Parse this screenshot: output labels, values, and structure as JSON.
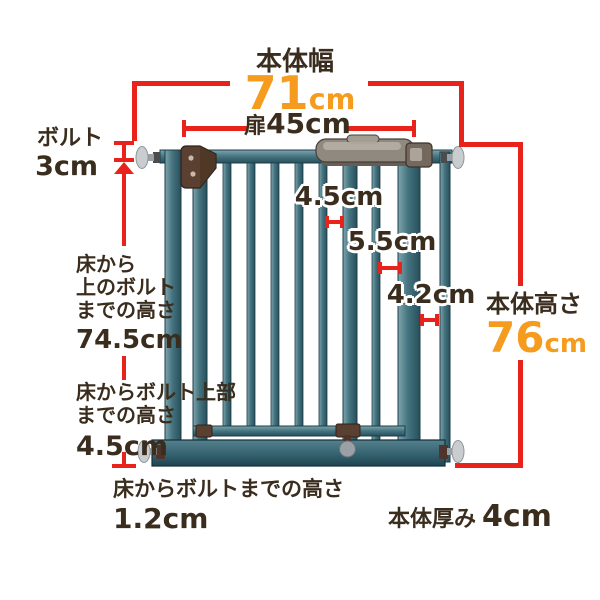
{
  "colors": {
    "background": "#ffffff",
    "dimension_red": "#e8231c",
    "number_orange": "#f59c1f",
    "text_dark": "#3a2d1e",
    "gate_teal": "#3f6d7b",
    "gate_teal_light": "#7fa5ae",
    "gate_teal_dark": "#274f5c",
    "hardware_brown": "#5a4030",
    "handle_gray": "#90897f",
    "bolt_gray": "#c9cdd0"
  },
  "annotations": {
    "body_width": {
      "label": "本体幅",
      "value": "71",
      "unit": "cm"
    },
    "door_width": {
      "label": "扉",
      "value": "45cm"
    },
    "bolt": {
      "label": "ボルト",
      "value": "3cm"
    },
    "floor_to_upper_bolt": {
      "lines": [
        "床から",
        "上のボルト",
        "までの高さ"
      ],
      "value": "74.5cm"
    },
    "floor_to_bolt_top": {
      "lines": [
        "床からボルト上部",
        "までの高さ"
      ],
      "value": "4.5cm"
    },
    "floor_to_bolt": {
      "label": "床からボルトまでの高さ",
      "value": "1.2cm"
    },
    "body_height": {
      "label": "本体高さ",
      "value": "76",
      "unit": "cm"
    },
    "bar_gap_1": "4.5cm",
    "bar_gap_2": "5.5cm",
    "bar_gap_3": "4.2cm",
    "body_thickness": {
      "label": "本体厚み",
      "value": "4cm"
    }
  }
}
